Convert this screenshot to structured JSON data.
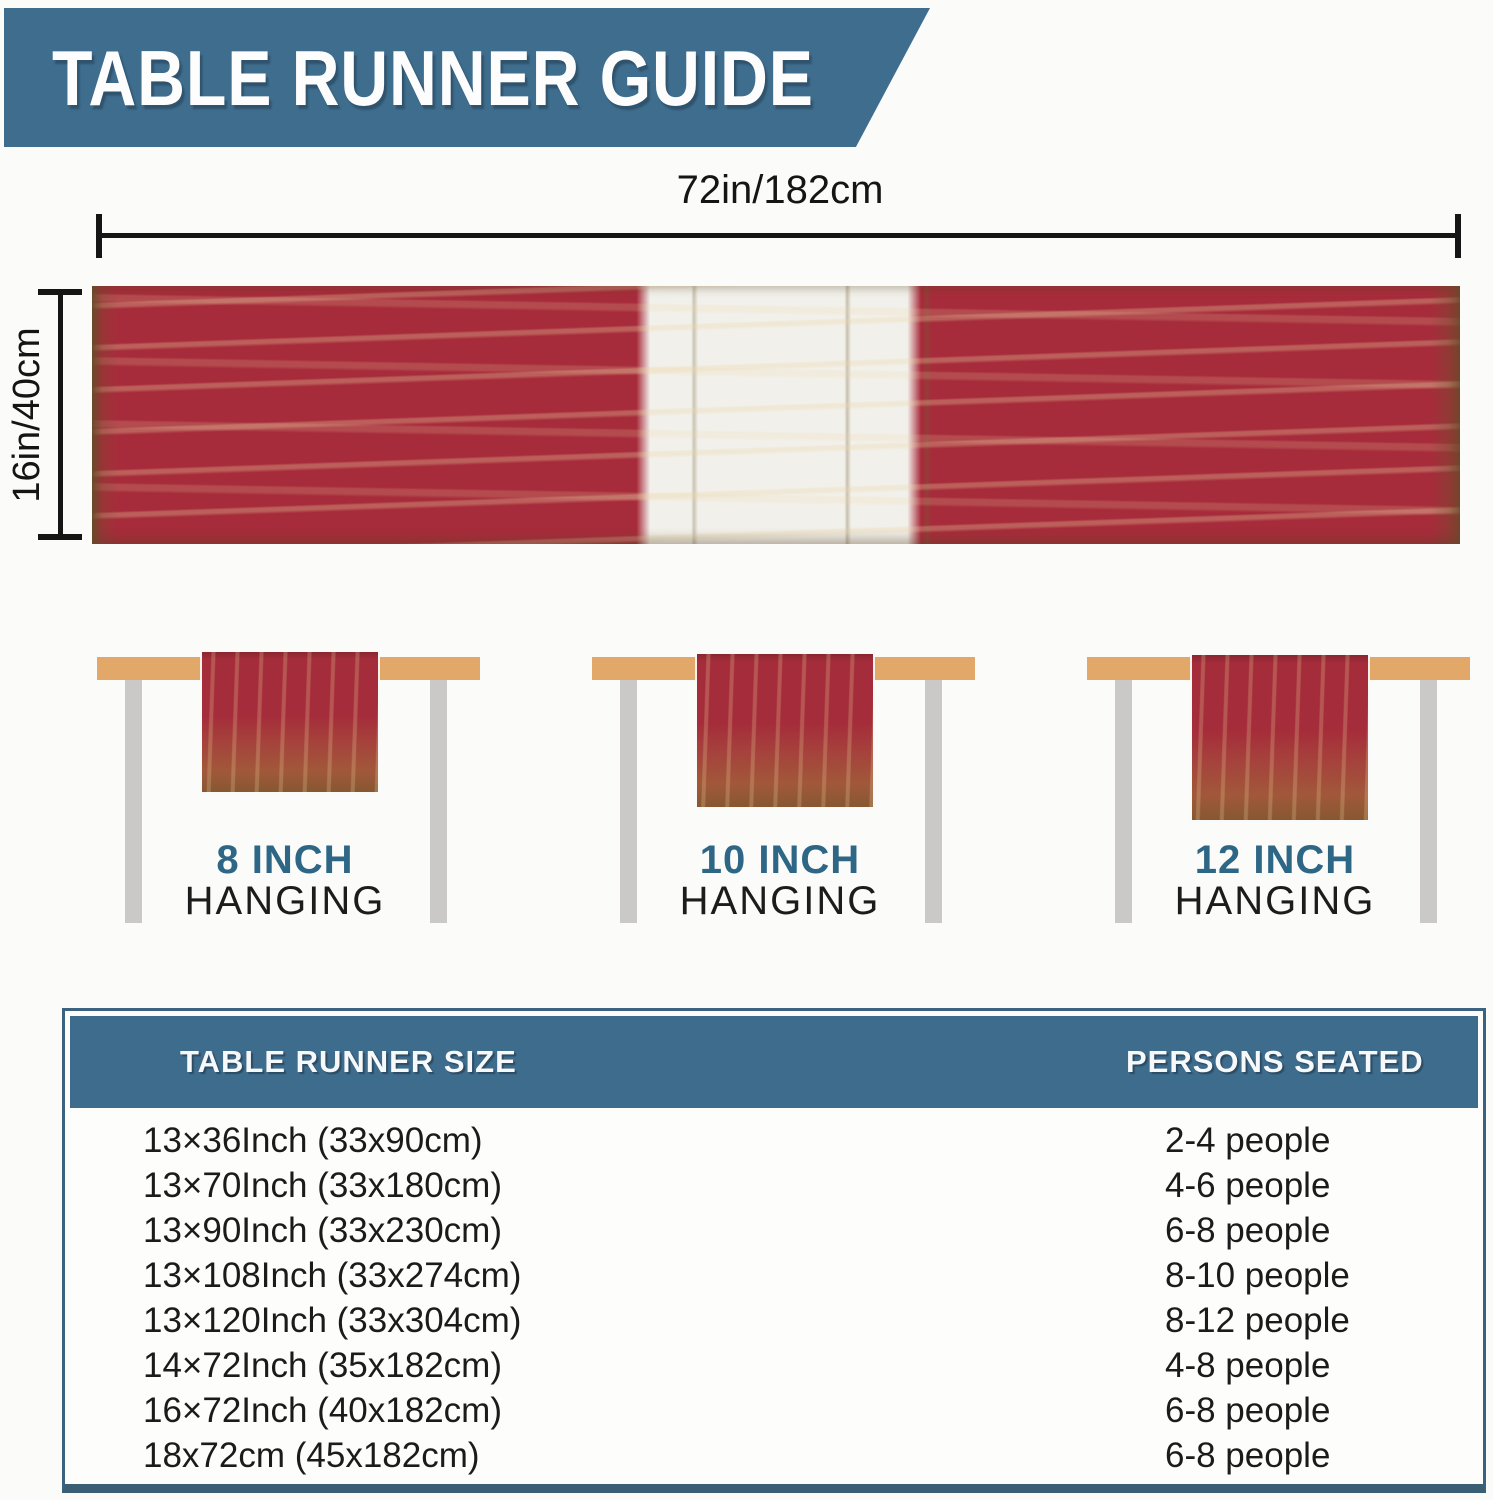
{
  "header": {
    "title": "TABLE RUNNER GUIDE"
  },
  "dimensions": {
    "width_label": "72in/182cm",
    "height_label": "16in/40cm"
  },
  "runner": {
    "description": "distressed red table runner with white center block",
    "red": "#a72c3b",
    "white": "#f2f0ea"
  },
  "hanging_figures": [
    {
      "inch_label": "8 INCH",
      "sub_label": "HANGING"
    },
    {
      "inch_label": "10 INCH",
      "sub_label": "HANGING"
    },
    {
      "inch_label": "12 INCH",
      "sub_label": "HANGING"
    }
  ],
  "size_table": {
    "columns": [
      "TABLE RUNNER SIZE",
      "PERSONS SEATED"
    ],
    "rows": [
      {
        "size": "13×36Inch (33x90cm)",
        "people": "2-4 people"
      },
      {
        "size": "13×70Inch (33x180cm)",
        "people": "4-6 people"
      },
      {
        "size": "13×90Inch (33x230cm)",
        "people": "6-8 people"
      },
      {
        "size": "13×108Inch (33x274cm)",
        "people": "8-10 people"
      },
      {
        "size": "13×120Inch (33x304cm)",
        "people": "8-12 people"
      },
      {
        "size": "14×72Inch (35x182cm)",
        "people": "4-8 people"
      },
      {
        "size": "16×72Inch (40x182cm)",
        "people": "6-8 people"
      },
      {
        "size": "18x72cm (45x182cm)",
        "people": "6-8 people"
      }
    ]
  },
  "colors": {
    "banner_blue": "#3e6d8e",
    "accent_blue": "#2e6686",
    "runner_red": "#a72c3b",
    "tabletop_tan": "#e1a869",
    "leg_gray": "#cbc9c7",
    "table_border": "#3a5f74",
    "text_dark": "#1c1c1c"
  }
}
